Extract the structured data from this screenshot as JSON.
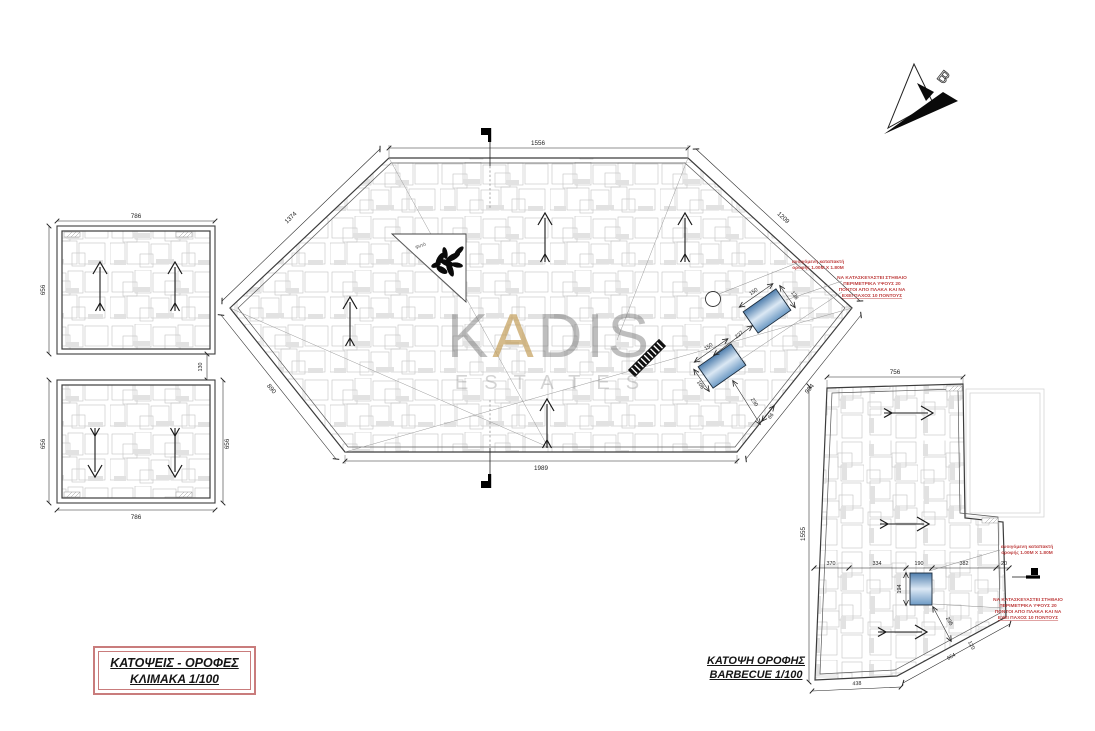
{
  "title_block": {
    "line1": "ΚΑΤΟΨΕΙΣ - ΟΡΟΦΕΣ",
    "line2": "ΚΛΙΜΑΚΑ 1/100"
  },
  "bbq_title": {
    "line1": "ΚΑΤΟΨΗ ΟΡΟΦΗΣ",
    "line2": "BARBECUE 1/100"
  },
  "watermark": {
    "part1": "K",
    "part2": "A",
    "part3": "DIS",
    "line2": "ESTATES",
    "accent_color": "#c19b54",
    "text_color": "#9a9a9a"
  },
  "north_arrow": {
    "letter": "B"
  },
  "annotations": {
    "hatch_line1": "ανοιγόμενη καταπακτή",
    "hatch_line2": "οροφής 1.00M X 1.80M",
    "parapet_line1": "ΝΑ ΚΑΤΑΣΚΕΥΑΣΤΕΙ ΣΤΗΘΑΙΟ",
    "parapet_line2": "ΠΕΡΙΜΕΤΡΙΚΑ ΥΨΟΥΣ 20",
    "parapet_line3": "ΠΟΝΤΟΙ ΑΠΟ ΠΛΑΚΑ ΚΑΙ ΝΑ",
    "parapet_line4": "ΕΧΕΙ ΠΑΧΟΣ 10 ΠΟΝΤΟΥΣ",
    "plant_label": "φυτό",
    "red_color": "#bf4040",
    "title_border_color": "#c97c7c"
  },
  "left_top_plan": {
    "dim_top": "786",
    "dim_left": "656"
  },
  "left_gap_dim": "130",
  "left_bottom_plan": {
    "dim_left": "656",
    "dim_right": "656",
    "dim_bottom": "786"
  },
  "main_plan": {
    "dim_top": "1556",
    "dim_top_left": "1374",
    "dim_top_right": "1209",
    "dim_bottom": "1989",
    "dim_bottom_left": "890",
    "dim_bottom_right": "994",
    "skylight1": {
      "dim_w": "150",
      "dim_s": "138"
    },
    "dim_between": "227",
    "skylight2": {
      "dim_w": "150",
      "dim_s": "108"
    },
    "dim_to_edge": "230",
    "dim_edge_offset": "66"
  },
  "bbq_plan": {
    "dim_top": "756",
    "dim_left": "1555",
    "dim_row": [
      "370",
      "334",
      "190",
      "382",
      "20"
    ],
    "dim_sky_h": "194",
    "dim_diag": "236",
    "dim_edge": "664",
    "dim_edge_small": "120",
    "dim_bottom": "438"
  }
}
